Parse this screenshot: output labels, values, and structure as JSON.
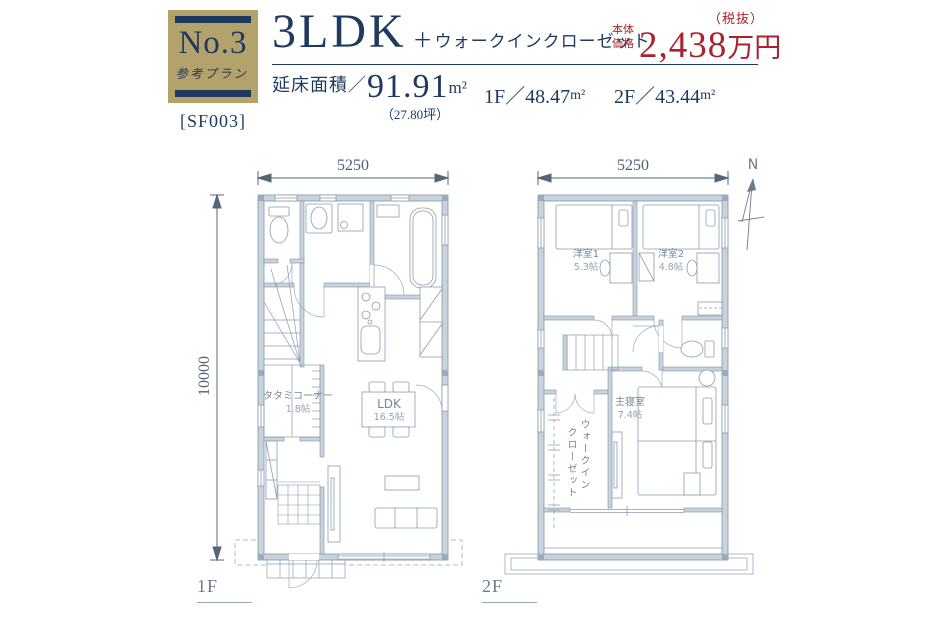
{
  "badge": {
    "number": "No.3",
    "type": "参考プラン",
    "code": "[SF003]"
  },
  "title": {
    "main": "3LDK",
    "plus": "＋",
    "sub": "ウォークインクローゼット"
  },
  "price": {
    "label1": "本体",
    "label2": "価格",
    "amount": "2,438",
    "unit": "万円",
    "tax": "（税抜）"
  },
  "areas": {
    "total_label": "延床面積／",
    "total_value": "91.91",
    "unit": "m²",
    "tsubo": "（27.80坪）",
    "f1": "1F／48.47",
    "f1_unit": "m²",
    "f2": "2F／43.44",
    "f2_unit": "m²"
  },
  "plan1": {
    "floor_label": "1F",
    "dim_width": "5250",
    "dim_height": "10000",
    "rooms": {
      "ldk_name": "LDK",
      "ldk_size": "16.5帖",
      "tatami_name": "タタミコーナー",
      "tatami_size": "1.8帖"
    }
  },
  "plan2": {
    "floor_label": "2F",
    "dim_width": "5250",
    "compass": "N",
    "rooms": {
      "bed1_name": "洋室1",
      "bed1_size": "5.3帖",
      "bed2_name": "洋室2",
      "bed2_size": "4.8帖",
      "master_name": "主寝室",
      "master_size": "7.4帖",
      "wic_line1": "ウォークイン",
      "wic_line2": "クローゼット"
    }
  },
  "colors": {
    "navy": "#1e3a5e",
    "gold": "#b4a26c",
    "red": "#a8232b",
    "wall": "#c9d3dc"
  }
}
